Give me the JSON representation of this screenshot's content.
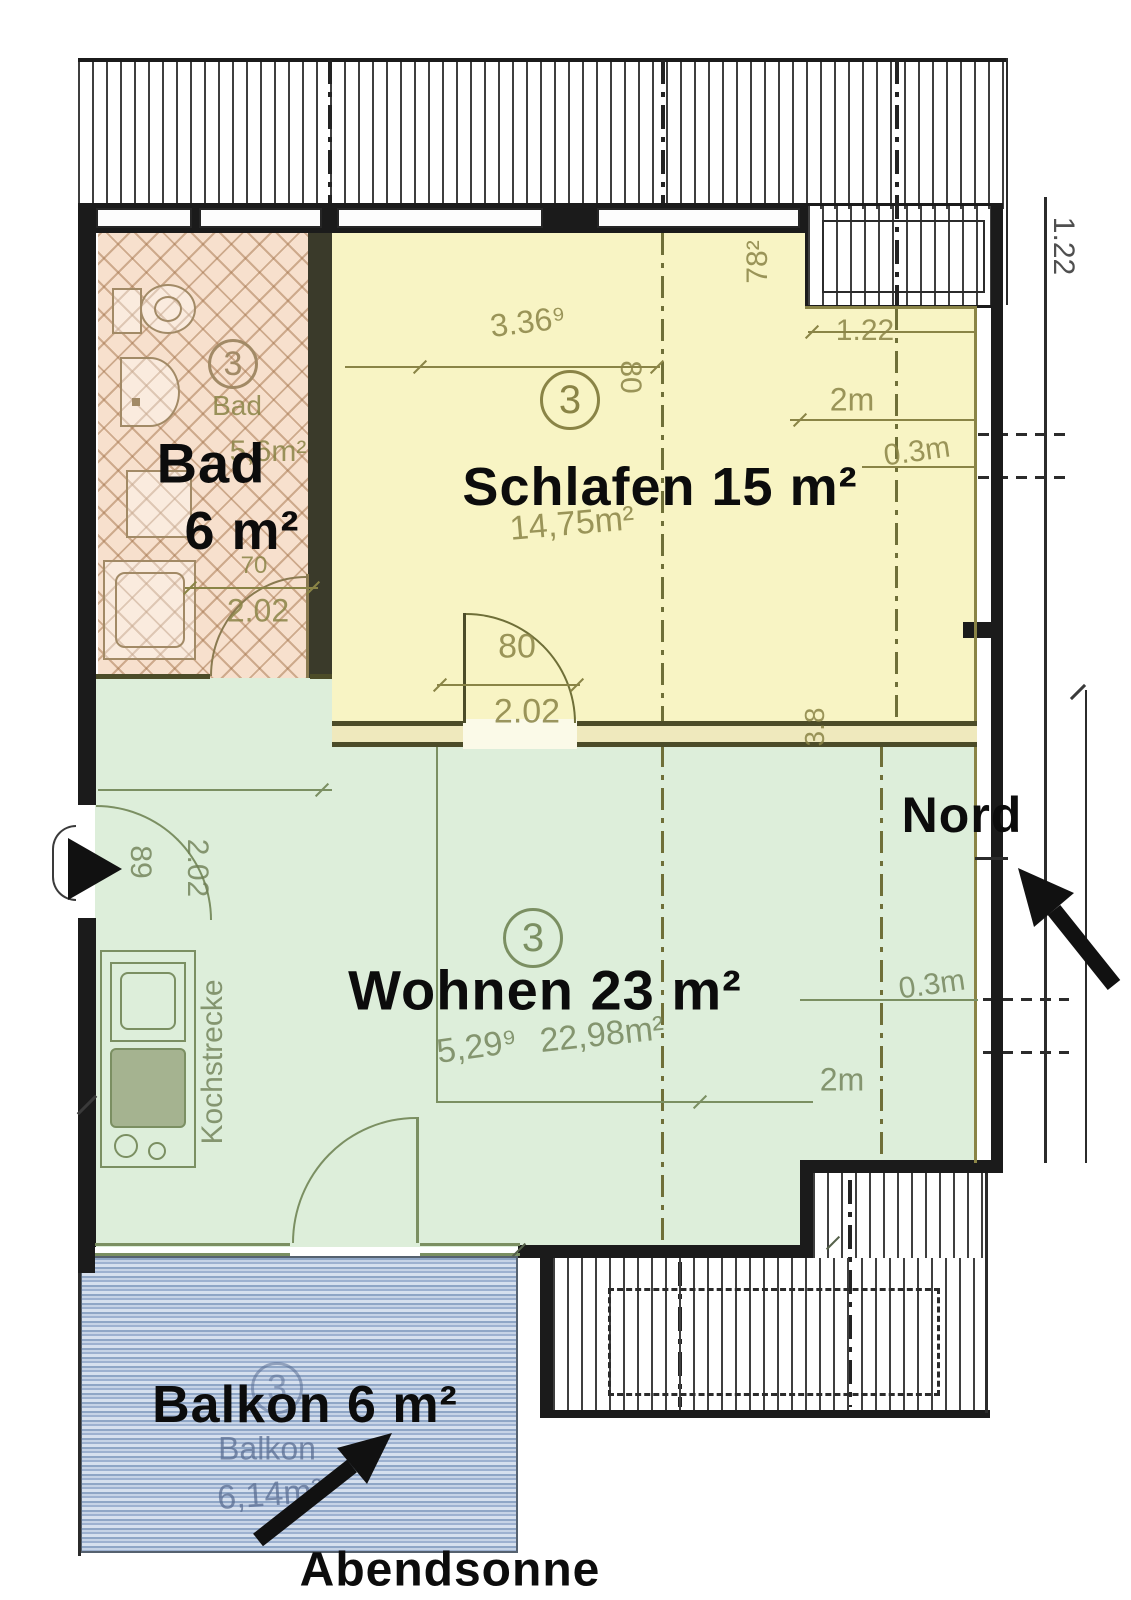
{
  "unit_number": "3",
  "compass": {
    "north": "Nord",
    "sun": "Abendsonne"
  },
  "rooms": {
    "bad": {
      "name": "Bad",
      "area": "6 m²",
      "orig_name": "Bad",
      "orig_area": "5,6m²"
    },
    "schlafen": {
      "label": "Schlafen 15 m²",
      "orig_area": "14,75m²"
    },
    "wohnen": {
      "label": "Wohnen 23 m²",
      "orig_len": "5,29⁹",
      "orig_area": "22,98m²"
    },
    "balkon": {
      "label": "Balkon 6 m²",
      "orig_name": "Balkon",
      "orig_area": "6,14m²"
    },
    "kitchen": {
      "label": "Kochstrecke"
    }
  },
  "dims": {
    "schlafen_width": "3.36⁹",
    "schlafen_w78": "78²",
    "schlafen_80v": "80",
    "top_122": "1.22",
    "top_2m": "2m",
    "top_03m": "0.3m",
    "door_w": "80",
    "door_h": "2.02",
    "bad_door_w": "70",
    "bad_door_h": "2.02",
    "entry_w": "89",
    "entry_h": "2.02",
    "wall_38": "3.8",
    "mid_03m": "0.3m",
    "mid_2m": "2m",
    "roof_122": "1.22"
  },
  "colors": {
    "bad_fill": "#f7e0cd",
    "schlafen_fill": "#f8f4c4",
    "wohnen_fill": "#ddeeda",
    "balkon_base": "#c6d3e6",
    "wall": "#1b1b1b",
    "plan_line": "#8a8446"
  }
}
